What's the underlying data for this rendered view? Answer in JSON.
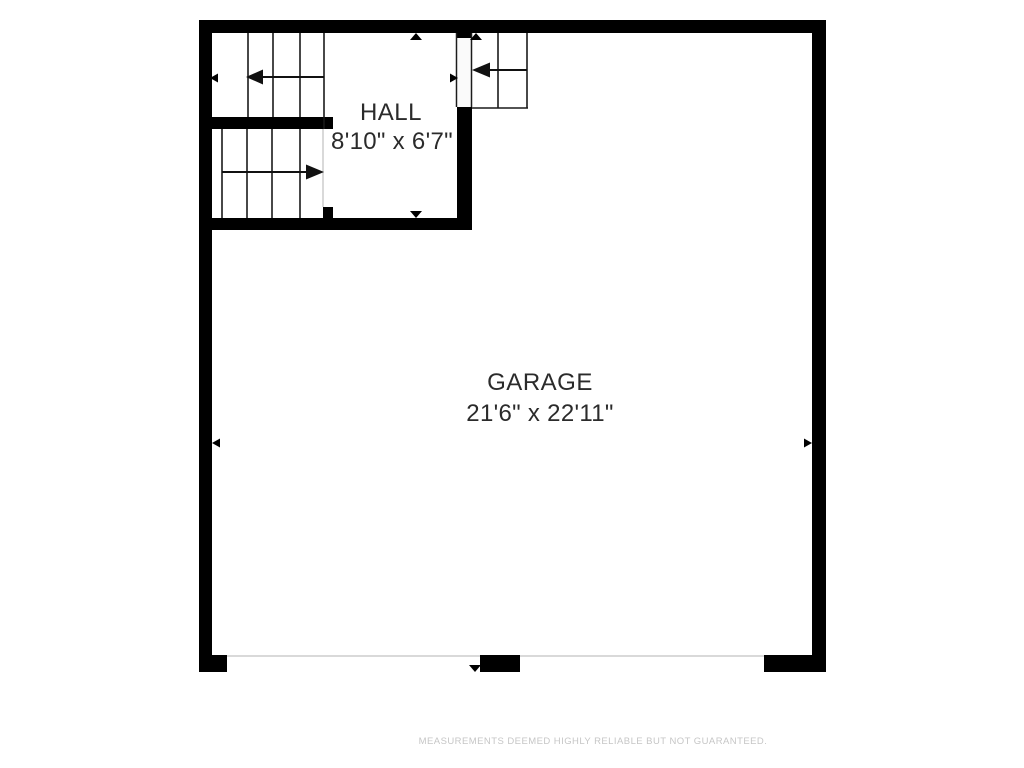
{
  "floorplan": {
    "rooms": [
      {
        "id": "hall",
        "name": "HALL",
        "dimensions": "8'10\" x 6'7\""
      },
      {
        "id": "garage",
        "name": "GARAGE",
        "dimensions": "21'6\" x 22'11\""
      }
    ],
    "disclaimer": "MEASUREMENTS DEEMED HIGHLY RELIABLE BUT NOT GUARANTEED.",
    "colors": {
      "background": "#ffffff",
      "wall": "#000000",
      "stair_line": "#1a1a1a",
      "garage_door_line": "#d9d9d9",
      "label_text": "#2b2b2b",
      "disclaimer_text": "#c6c6c6"
    },
    "icons": {
      "stair-direction-arrow": "solid black triangle arrowhead on thin shaft",
      "dimension-marker": "small solid black triangle pointing at wall"
    }
  }
}
